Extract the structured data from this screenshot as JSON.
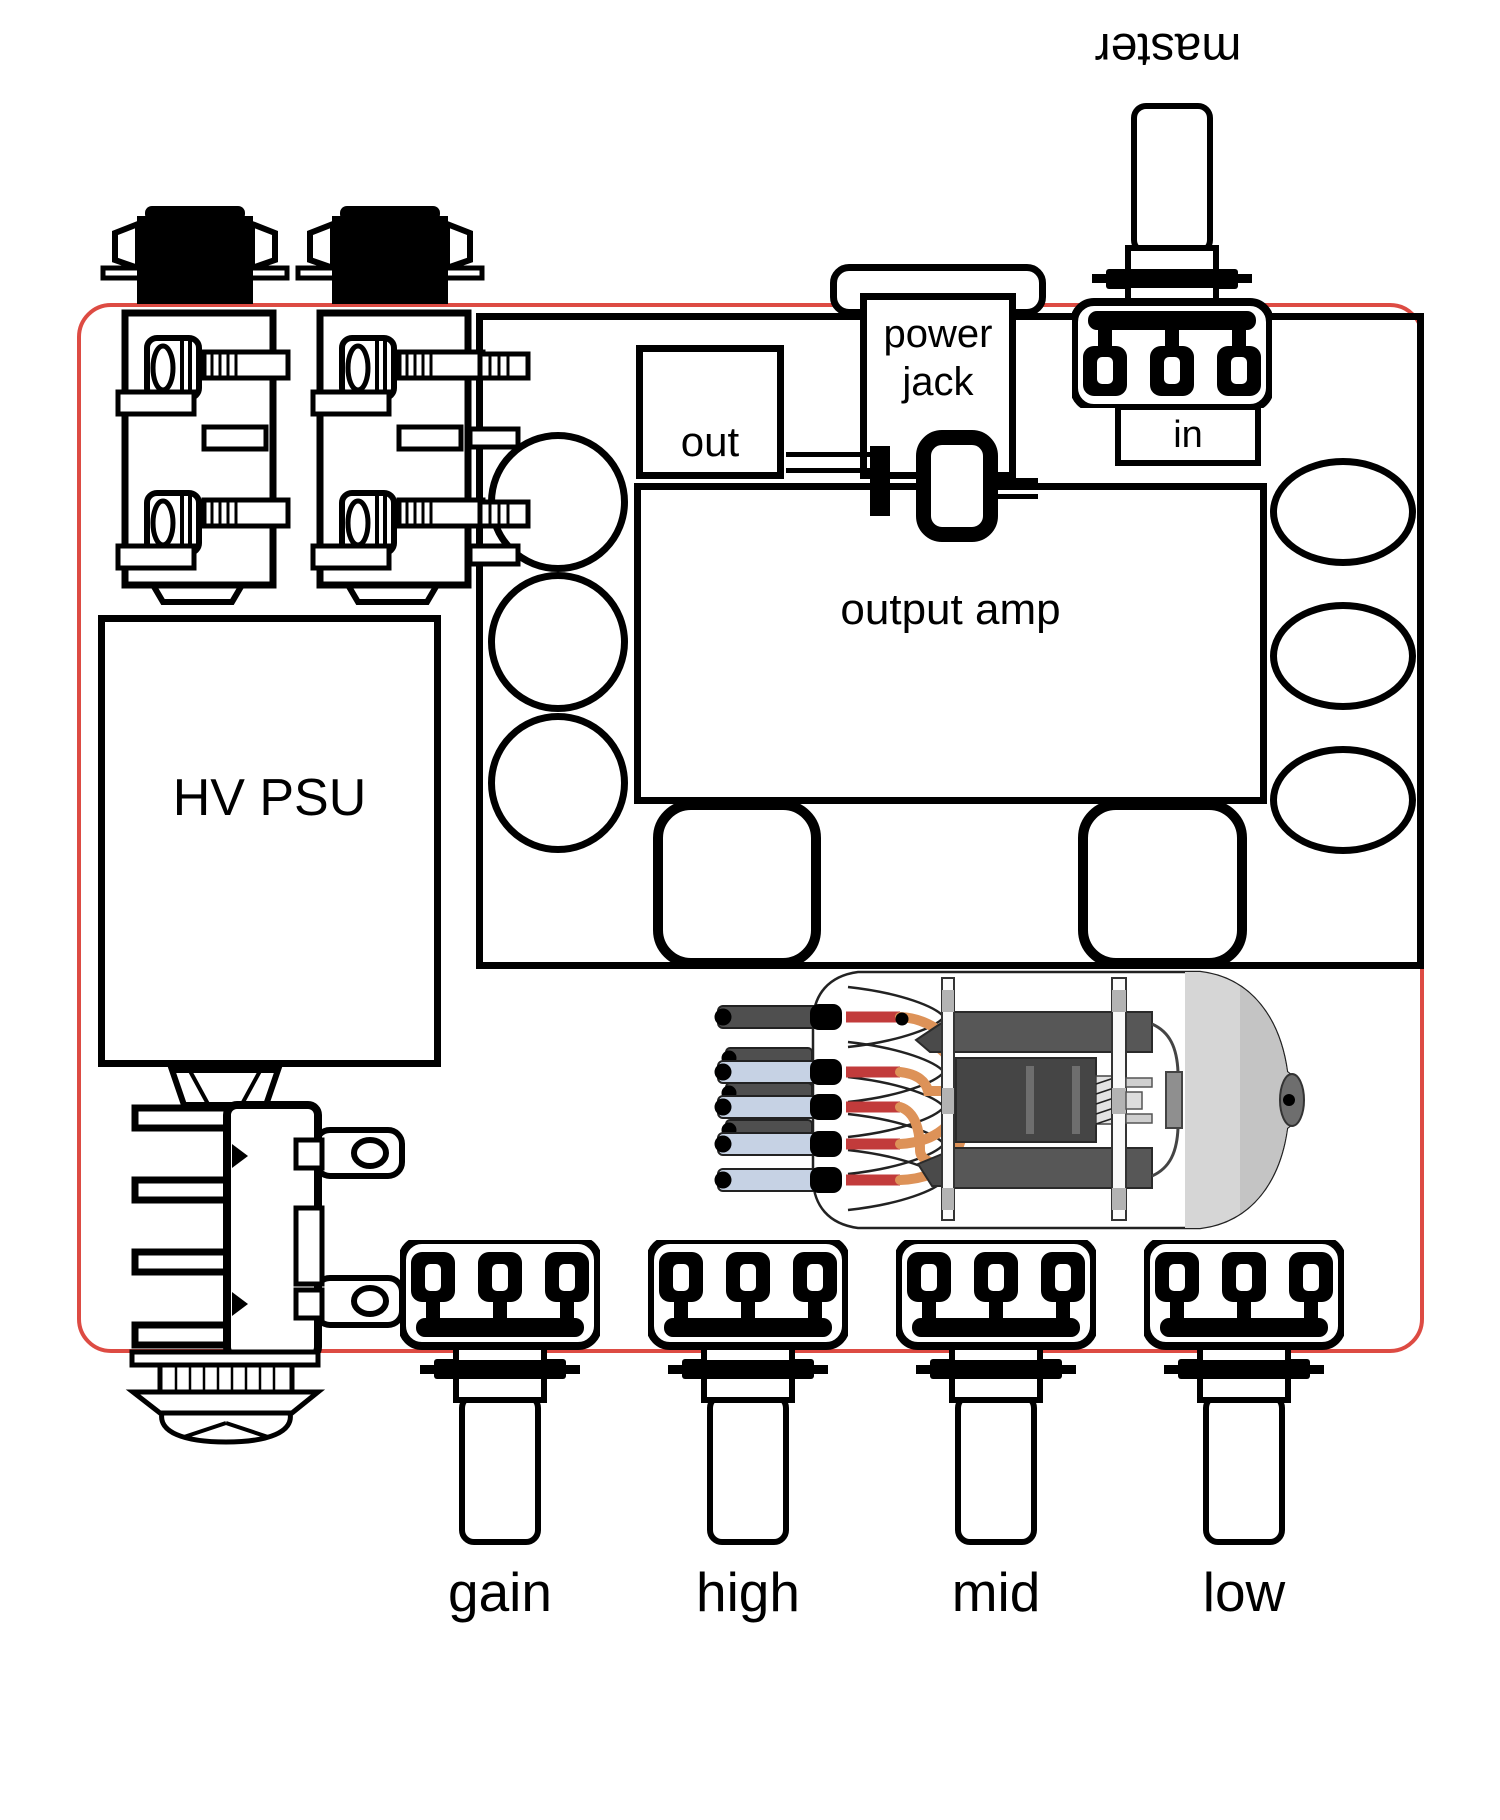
{
  "labels": {
    "master": "master",
    "power_line1": "power",
    "power_line2": "jack",
    "out": "out",
    "in": "in",
    "output_amp": "output amp",
    "hv_psu": "HV PSU"
  },
  "knobs": [
    {
      "label": "gain"
    },
    {
      "label": "high"
    },
    {
      "label": "mid"
    },
    {
      "label": "low"
    }
  ],
  "colors": {
    "board_outline": "#dd4b43",
    "ink": "#000000",
    "pin_blue": "#c6d2e4",
    "wire_orange": "#dd9258",
    "stub_red": "#c23b3b",
    "plate_gray": "#575757",
    "plate_dark": "#454545",
    "glass_gray": "#d6d6d6"
  }
}
